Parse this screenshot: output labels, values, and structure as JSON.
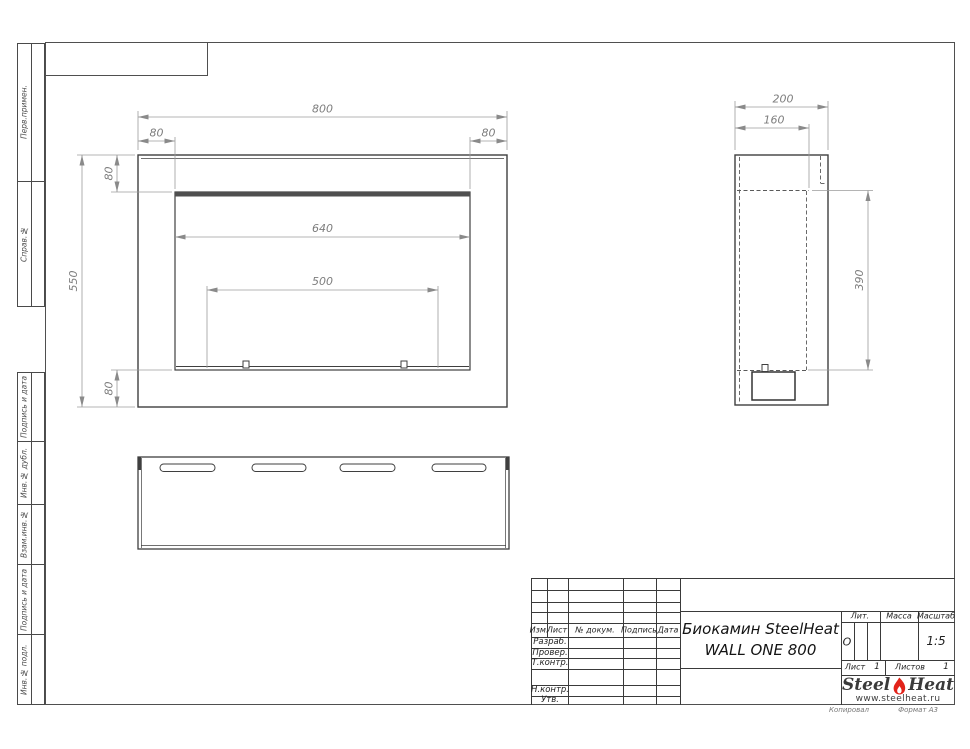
{
  "sidebar": {
    "items": [
      "Перв.примен.",
      "Справ.№",
      "Подпись и дата",
      "Инв.№ дубл.",
      "Взам.инв.№",
      "Подпись и дата",
      "Инв.№ подл."
    ]
  },
  "views": {
    "front": {
      "dim_width": "800",
      "dim_flange_left": "80",
      "dim_flange_right": "80",
      "dim_flange_top": "80",
      "dim_height": "550",
      "dim_flange_bottom": "80",
      "dim_opening_width": "640",
      "dim_burner_width": "500"
    },
    "side": {
      "dim_depth": "200",
      "dim_inner_depth": "160",
      "dim_opening_height": "390"
    }
  },
  "title_block": {
    "header_cols": [
      "Изм.",
      "Лист",
      "№ докум.",
      "Подпись",
      "Дата"
    ],
    "role_rows": [
      "Разраб.",
      "Провер.",
      "Т.контр.",
      "Н.контр.",
      "Утв."
    ],
    "title_line1": "Биокамин SteelHeat",
    "title_line2": "WALL ONE 800",
    "lit_label": "Лит.",
    "lit_value": "О",
    "mass_label": "Масса",
    "scale_label": "Масштаб",
    "scale_value": "1:5",
    "sheet_label": "Лист",
    "sheet_value": "1",
    "sheets_label": "Листов",
    "sheets_value": "1",
    "logo": {
      "word1": "Steel",
      "word2": "Heat",
      "url": "www.steelheat.ru",
      "flame_color": "#e2231a"
    },
    "footer_left": "Копировал",
    "footer_right": "Формат А3"
  }
}
